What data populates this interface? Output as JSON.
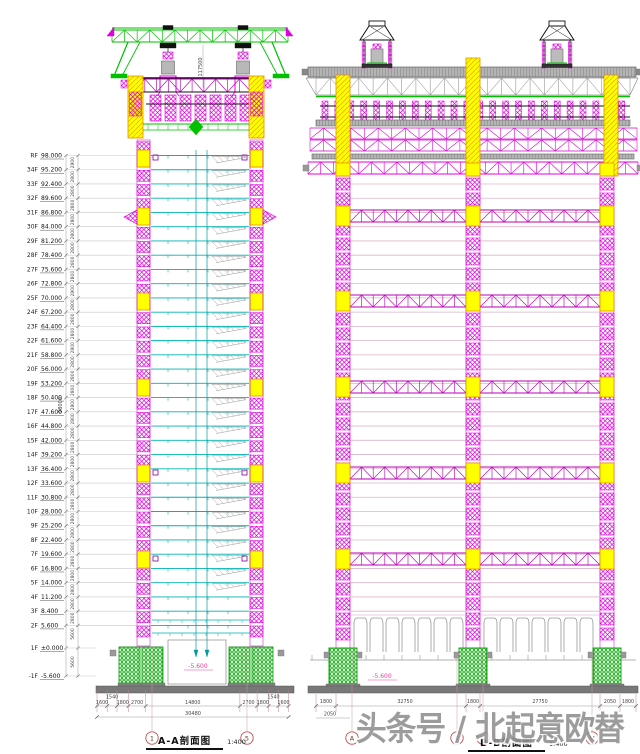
{
  "watermark": {
    "text": "头条号 / 北起意欧替"
  },
  "colors": {
    "magenta": "#e000e0",
    "dark_magenta": "#b800b8",
    "yellow": "#ffff00",
    "yellow_edge": "#e89000",
    "green": "#00c000",
    "foundation_green": "#00a000",
    "cyan": "#00b2b2",
    "gray": "#999999",
    "deck_gray": "#b4b4b4",
    "mat_gray": "#787878",
    "floorline_pink": "#dcb6c6",
    "dim_text": "#444444",
    "grid_red": "#c05050",
    "pink": "#f0409a",
    "line_gray": "#c8c8c8",
    "black": "#111111"
  },
  "left_view": {
    "title": "A-A剖面图",
    "scale": "1:400",
    "gantry_height_dim": "117500",
    "overall_height_dim": "98000",
    "typical_floor_dim": "2800",
    "basement_floor_dim": "5600",
    "pit_elevation": "-5.600",
    "grid_bubbles": [
      "1",
      "5"
    ],
    "floors": [
      [
        "RF",
        "98.000"
      ],
      [
        "34F",
        "95.200"
      ],
      [
        "33F",
        "92.400"
      ],
      [
        "32F",
        "89.600"
      ],
      [
        "31F",
        "86.800"
      ],
      [
        "30F",
        "84.000"
      ],
      [
        "29F",
        "81.200"
      ],
      [
        "28F",
        "78.400"
      ],
      [
        "27F",
        "75.600"
      ],
      [
        "26F",
        "72.800"
      ],
      [
        "25F",
        "70.000"
      ],
      [
        "24F",
        "67.200"
      ],
      [
        "23F",
        "64.400"
      ],
      [
        "22F",
        "61.600"
      ],
      [
        "21F",
        "58.800"
      ],
      [
        "20F",
        "56.000"
      ],
      [
        "19F",
        "53.200"
      ],
      [
        "18F",
        "50.400"
      ],
      [
        "17F",
        "47.600"
      ],
      [
        "16F",
        "44.800"
      ],
      [
        "15F",
        "42.000"
      ],
      [
        "14F",
        "39.200"
      ],
      [
        "13F",
        "36.400"
      ],
      [
        "12F",
        "33.600"
      ],
      [
        "11F",
        "30.800"
      ],
      [
        "10F",
        "28.000"
      ],
      [
        "9F",
        "25.200"
      ],
      [
        "8F",
        "22.400"
      ],
      [
        "7F",
        "19.600"
      ],
      [
        "6F",
        "16.800"
      ],
      [
        "5F",
        "14.000"
      ],
      [
        "4F",
        "11.200"
      ],
      [
        "3F",
        "8.400"
      ],
      [
        "2F",
        "5.600"
      ],
      [
        "1F",
        "±0.000"
      ],
      [
        "-1F",
        "-5.600"
      ]
    ],
    "bottom_dims": [
      "1600",
      "1540",
      "1800",
      "2700",
      "14800",
      "2700",
      "1800",
      "1540",
      "1600"
    ],
    "total_dim": "30480"
  },
  "right_view": {
    "title": "B-B剖面图",
    "scale": "1:400",
    "pit_elevation": "-5.600",
    "grid_bubbles": [
      "A",
      "F",
      "G",
      "M"
    ],
    "bottom_dims_row1": [
      "1800",
      "32750",
      "1800",
      "27750",
      "2050",
      "1800"
    ],
    "bottom_dims_row2": [
      "2050"
    ]
  }
}
